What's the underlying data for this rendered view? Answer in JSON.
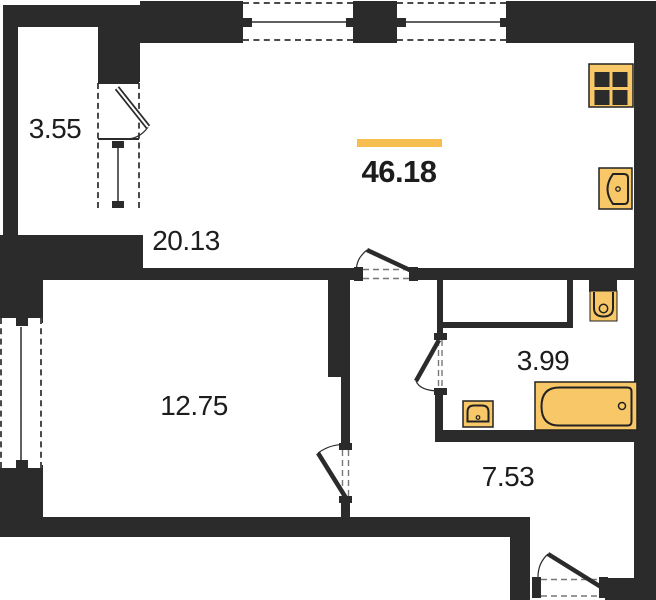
{
  "plan": {
    "total_area": "46.18",
    "rooms": [
      {
        "name": "balcony",
        "area": "3.55"
      },
      {
        "name": "living-kitchen",
        "area": "20.13"
      },
      {
        "name": "bedroom",
        "area": "12.75"
      },
      {
        "name": "bathroom",
        "area": "3.99"
      },
      {
        "name": "hallway",
        "area": "7.53"
      }
    ],
    "icons": [
      "stove-icon",
      "kitchen-sink-icon",
      "toilet-icon",
      "bathroom-sink-icon",
      "bathtub-icon"
    ],
    "colors": {
      "wall": "#2B2B2B",
      "fixture_fill": "#F8C767",
      "accent_bar": "#F6BD4F",
      "text": "#1D1D1D"
    }
  }
}
